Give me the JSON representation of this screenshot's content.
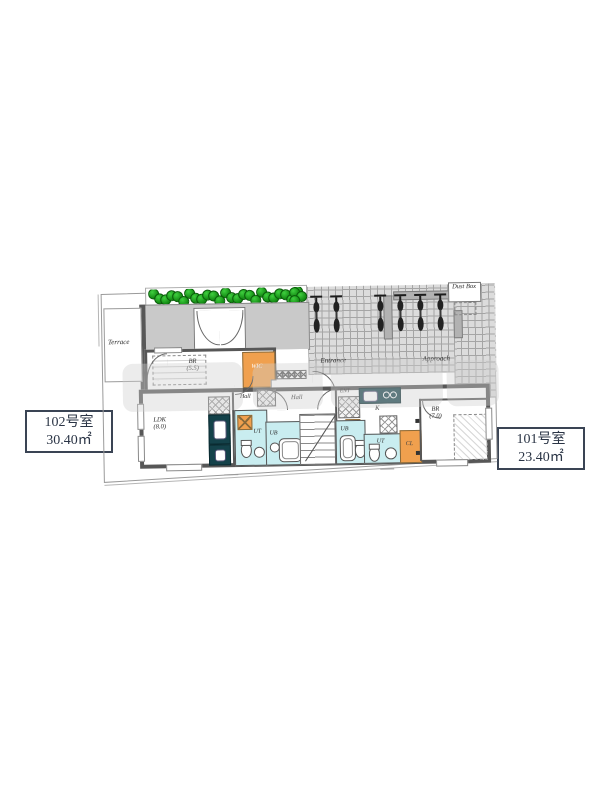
{
  "unit_boxes": {
    "left": {
      "room": "102号室",
      "area": "30.40㎡"
    },
    "right": {
      "room": "101号室",
      "area": "23.40㎡"
    }
  },
  "site": {
    "terrace": "Terrace",
    "entrance": "Entrance",
    "approach": "Approach",
    "dust_box": "Dust Box"
  },
  "unit102": {
    "br": "BR",
    "br_size": "(5.5)",
    "wic": "WIC",
    "hall": "Hall",
    "ldk": "LDK",
    "ldk_size": "(8.0)",
    "ut": "UT",
    "ub": "UB"
  },
  "shared": {
    "hall": "Hall"
  },
  "unit101": {
    "ent": "ENT",
    "kitchen": "K",
    "ub": "UB",
    "ut": "UT",
    "cl": "CL",
    "br": "BR",
    "br_size": "(7.0)"
  },
  "colors": {
    "accent_orange": "#f0a04e",
    "wet_room_cyan": "#c9edf0",
    "bush_green": "#128a12",
    "wall_gray": "#575757",
    "paving_gray": "#dcdcdc",
    "counter_teal": "#14424a",
    "label_text": "#2b3546"
  },
  "decor": {
    "bush_count": 25,
    "bush_cluster_count": 3,
    "bike_x": [
      216,
      236,
      280,
      300,
      320,
      340
    ],
    "mailbox_cells": 5
  }
}
